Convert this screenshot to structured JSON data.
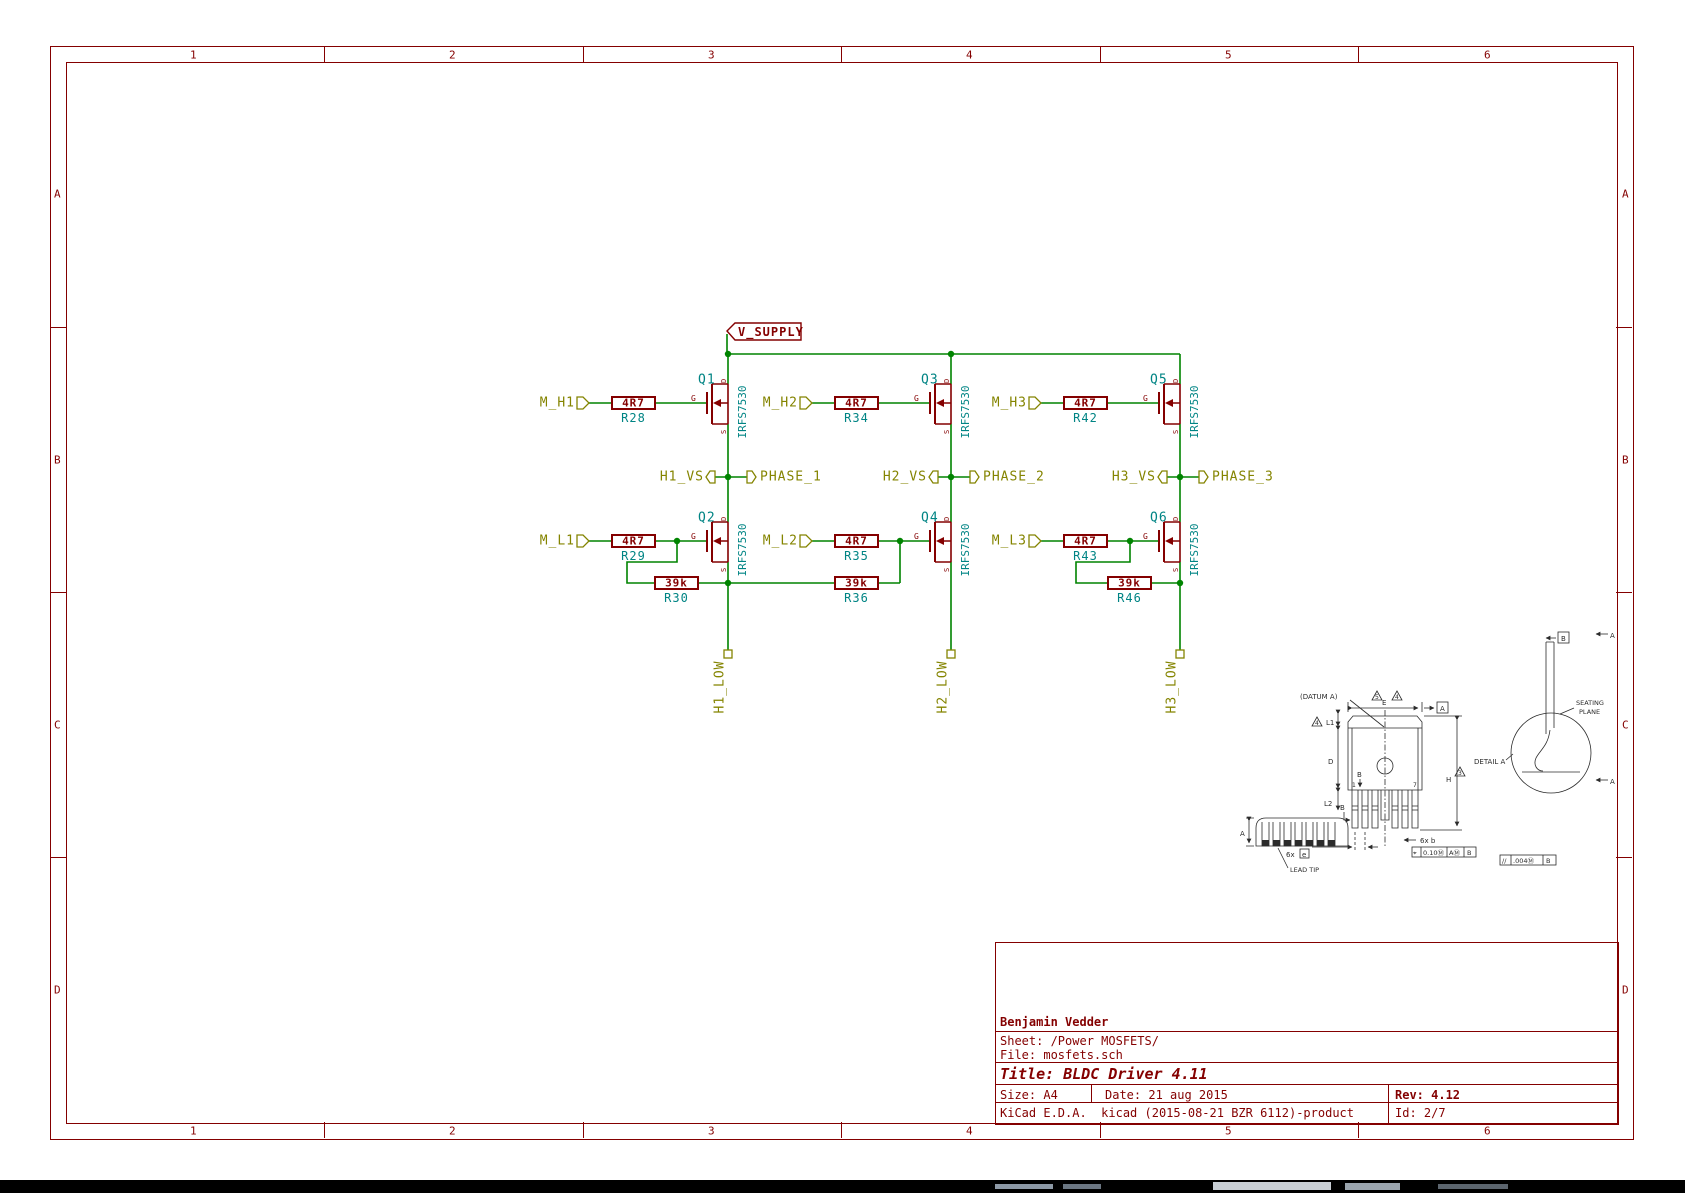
{
  "app": {
    "kind": "kicad-eeschema-printout"
  },
  "colors": {
    "wire": "#008400",
    "component": "#840000",
    "field_text": "#008484",
    "hier_label": "#848400",
    "frame": "#840000",
    "mech_drawing": "#2b2b2b",
    "taskbar": "#000000",
    "paper": "#ffffff"
  },
  "frame": {
    "cols": [
      "1",
      "2",
      "3",
      "4",
      "5",
      "6"
    ],
    "rows": [
      "A",
      "B",
      "C",
      "D"
    ]
  },
  "power": {
    "label": "V_SUPPLY"
  },
  "pins": {
    "g": "G",
    "d": "D",
    "s": "S"
  },
  "bridges": [
    {
      "m_h": "M_H1",
      "r_h_val": "4R7",
      "r_h_ref": "R28",
      "q_h_ref": "Q1",
      "q_h_val": "IRFS7530",
      "h_vs": "H1_VS",
      "phase": "PHASE_1",
      "m_l": "M_L1",
      "r_l_val": "4R7",
      "r_l_ref": "R29",
      "q_l_ref": "Q2",
      "q_l_val": "IRFS7530",
      "pd_val": "39k",
      "pd_ref": "R30",
      "low": "H1_LOW"
    },
    {
      "m_h": "M_H2",
      "r_h_val": "4R7",
      "r_h_ref": "R34",
      "q_h_ref": "Q3",
      "q_h_val": "IRFS7530",
      "h_vs": "H2_VS",
      "phase": "PHASE_2",
      "m_l": "M_L2",
      "r_l_val": "4R7",
      "r_l_ref": "R35",
      "q_l_ref": "Q4",
      "q_l_val": "IRFS7530",
      "pd_val": "39k",
      "pd_ref": "R36",
      "low": "H2_LOW"
    },
    {
      "m_h": "M_H3",
      "r_h_val": "4R7",
      "r_h_ref": "R42",
      "q_h_ref": "Q5",
      "q_h_val": "IRFS7530",
      "h_vs": "H3_VS",
      "phase": "PHASE_3",
      "m_l": "M_L3",
      "r_l_val": "4R7",
      "r_l_ref": "R43",
      "q_l_ref": "Q6",
      "q_l_val": "IRFS7530",
      "pd_val": "39k",
      "pd_ref": "R46",
      "low": "H3_LOW"
    }
  ],
  "title_block": {
    "author": "Benjamin Vedder",
    "sheet": "Sheet: /Power MOSFETS/",
    "file": "File: mosfets.sch",
    "title": "Title: BLDC Driver 4.11",
    "size": "Size: A4",
    "date": "Date: 21 aug 2015",
    "rev": "Rev: 4.12",
    "tool": "KiCad E.D.A.  kicad (2015-08-21 BZR 6112)-product",
    "id": "Id: 2/7"
  },
  "mech": {
    "datum_note": "(DATUM A)",
    "tri5": "5",
    "tri4": "4",
    "tri4b": "4",
    "tri3": "3",
    "dim_e": "E",
    "a_box": "A",
    "dim_l1": "L1",
    "dim_d": "D",
    "dim_l2": "L2",
    "dim_b": "B",
    "dim_b2": "B",
    "dim_h": "H",
    "pin1": "1",
    "pin7": "7",
    "note_6x": "6x",
    "e_box": "e",
    "note_6xb": "6x b",
    "fcf_sym": "⌖",
    "fcf_tol": "0.10Ⓜ",
    "fcf_a": "AⓂ",
    "fcf_b": "B",
    "detail_a": "DETAIL A",
    "seating": "SEATING",
    "plane": "PLANE",
    "b_box": "B",
    "par_sym": "//",
    "par_tol": ".004Ⓜ",
    "par_b": "B",
    "sec_a_top": "A",
    "sec_a_bot": "A",
    "dim_a": "A",
    "lead_tip": "LEAD TIP"
  }
}
